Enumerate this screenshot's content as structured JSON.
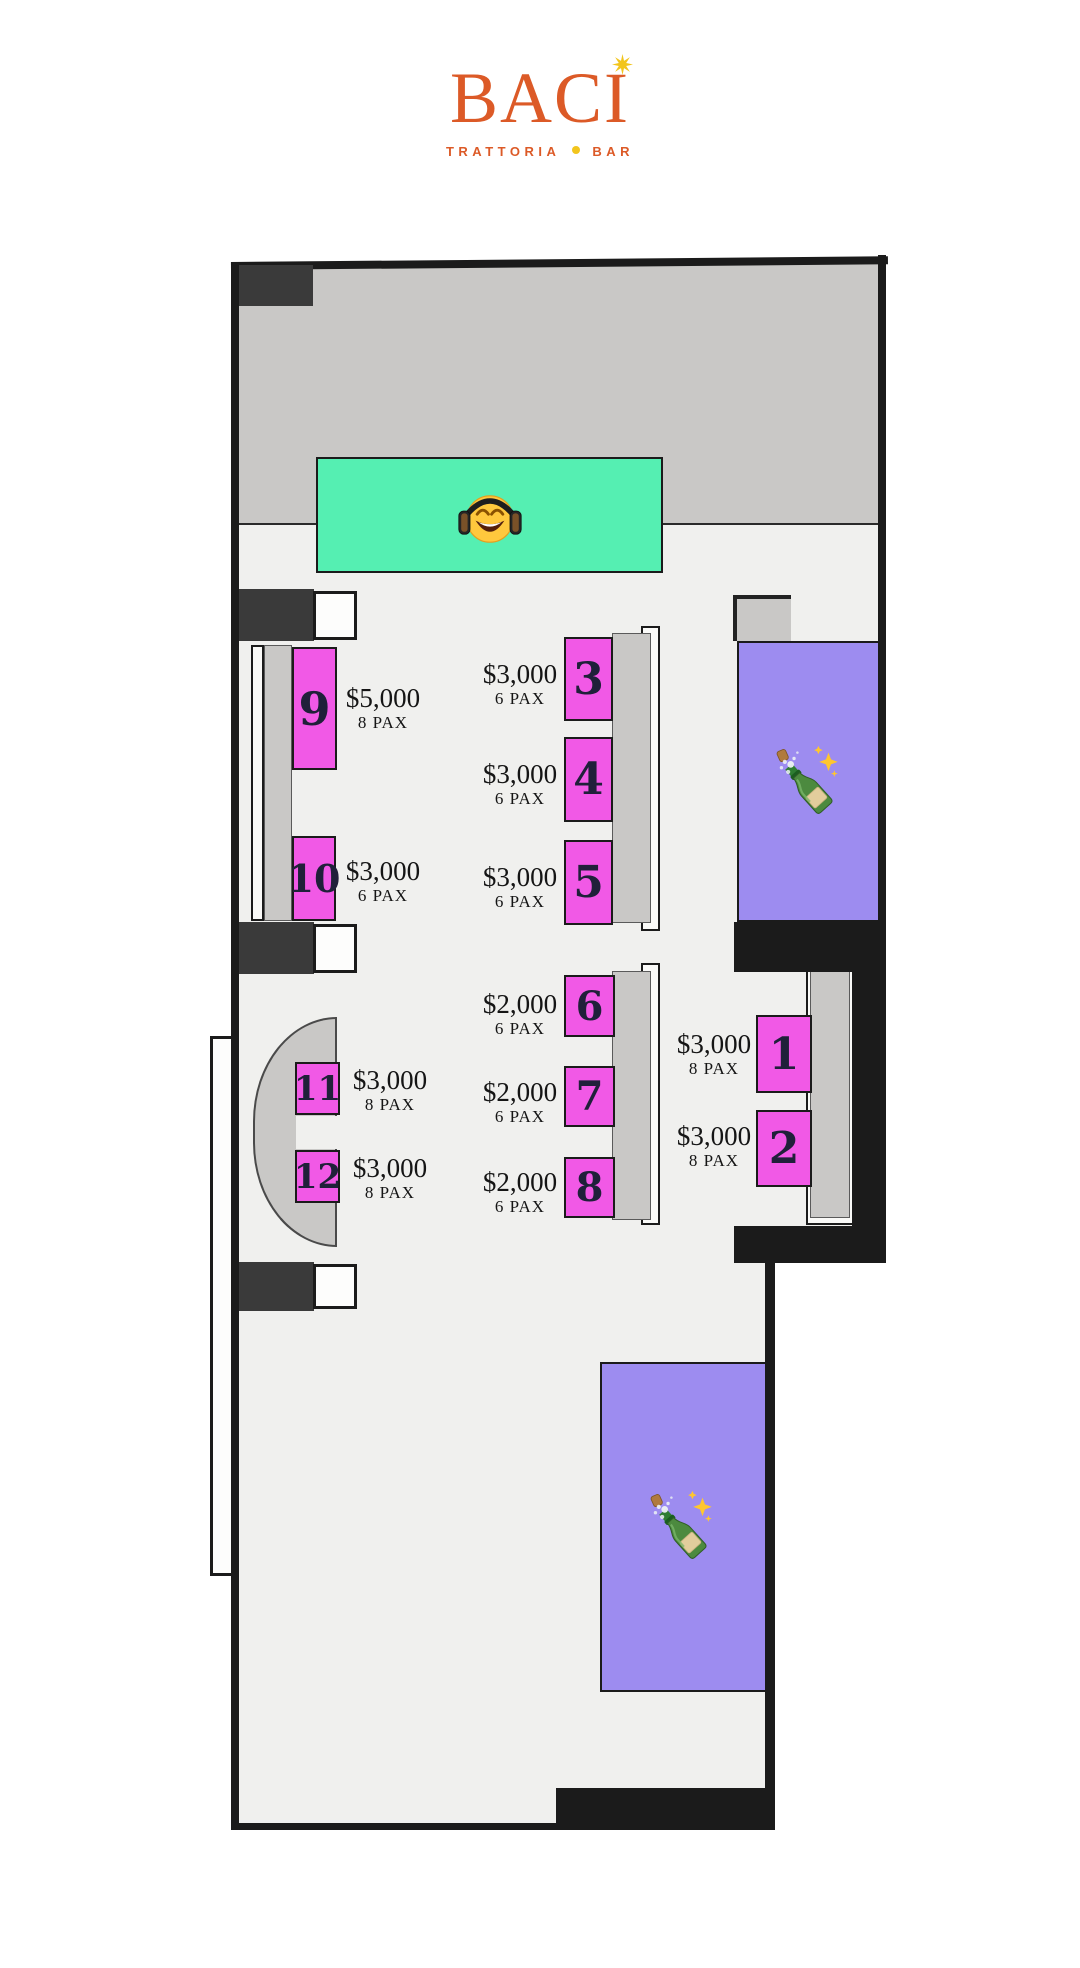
{
  "brand": {
    "name": "BACI",
    "tagline_primary": "TRATTORIA",
    "tagline_secondary": "BAR"
  },
  "floorplan": {
    "tables": [
      {
        "number": "1",
        "price": "$3,000",
        "pax": "8 PAX"
      },
      {
        "number": "2",
        "price": "$3,000",
        "pax": "8 PAX"
      },
      {
        "number": "3",
        "price": "$3,000",
        "pax": "6 PAX"
      },
      {
        "number": "4",
        "price": "$3,000",
        "pax": "6 PAX"
      },
      {
        "number": "5",
        "price": "$3,000",
        "pax": "6 PAX"
      },
      {
        "number": "6",
        "price": "$2,000",
        "pax": "6 PAX"
      },
      {
        "number": "7",
        "price": "$2,000",
        "pax": "6 PAX"
      },
      {
        "number": "8",
        "price": "$2,000",
        "pax": "6 PAX"
      },
      {
        "number": "9",
        "price": "$5,000",
        "pax": "8 PAX"
      },
      {
        "number": "10",
        "price": "$3,000",
        "pax": "6 PAX"
      },
      {
        "number": "11",
        "price": "$3,000",
        "pax": "8 PAX"
      },
      {
        "number": "12",
        "price": "$3,000",
        "pax": "8 PAX"
      }
    ],
    "icons": {
      "dj_booth": "headphones-smiley-emoji",
      "vip_right": "champagne-bottle-emoji",
      "vip_bottom": "champagne-bottle-emoji",
      "logo_dot": "star-sparkle"
    },
    "colors": {
      "table_pink": "#F159E6",
      "dj_teal": "#55EFB2",
      "vip_purple": "#9D8CF0",
      "stage_gray": "#C9C8C6",
      "floor": "#F0F0EE",
      "wall": "#1B1B1B",
      "brand_orange": "#DC5A27",
      "star_yellow": "#F2C51D"
    }
  }
}
